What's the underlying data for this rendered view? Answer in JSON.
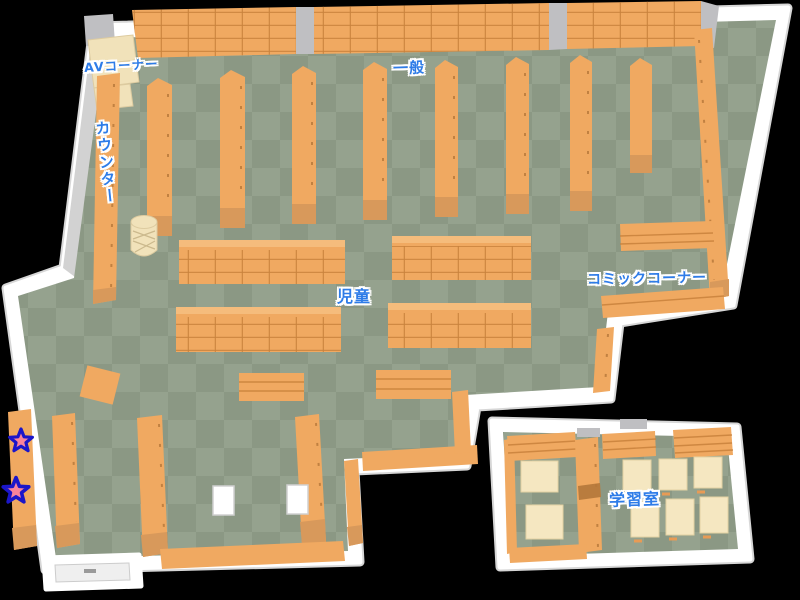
{
  "map": {
    "type": "library-floor-plan",
    "areas": [
      {
        "id": "av_corner",
        "label": "AVコーナー"
      },
      {
        "id": "general",
        "label": "一般"
      },
      {
        "id": "counter",
        "label": "カウンター"
      },
      {
        "id": "children",
        "label": "児童"
      },
      {
        "id": "comic_corner",
        "label": "コミックコーナー"
      },
      {
        "id": "study_room",
        "label": "学習室"
      }
    ],
    "markers": [
      {
        "id": "star-marker-1",
        "type": "star"
      },
      {
        "id": "star-marker-2",
        "type": "star"
      }
    ],
    "colors": {
      "background": "#000000",
      "label_text": "#2e7ce8",
      "wall": "#ffffff",
      "wall_shade": "#d7d7d7",
      "floor_light": "#95a28e",
      "floor_dark": "#8b9884",
      "shelf": "#f0a961",
      "shelf_dark": "#d8995b",
      "av_unit": "#f1e2ba",
      "desk": "#f5e7c1",
      "star_fill": "#f9849b",
      "star_outline": "#1b16c9"
    }
  }
}
